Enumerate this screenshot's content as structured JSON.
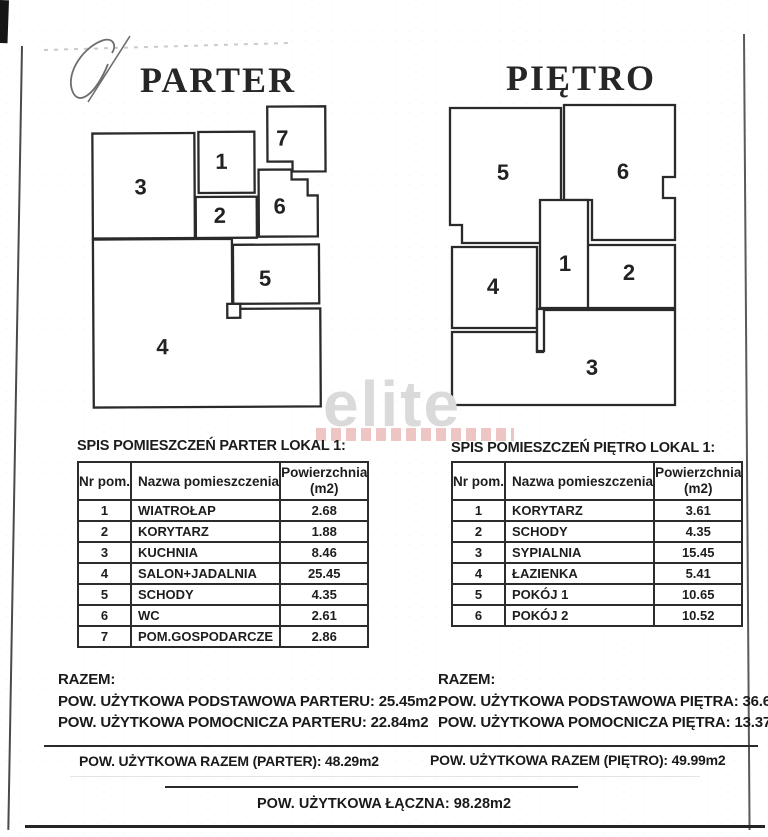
{
  "watermark": "elite",
  "grand_total": "POW. UŻYTKOWA ŁĄCZNA: 98.28m2",
  "parter": {
    "title": "PARTER",
    "plan_labels": [
      "1",
      "2",
      "3",
      "4",
      "5",
      "6",
      "7"
    ],
    "table_title": "SPIS POMIESZCZEŃ PARTER LOKAL 1:",
    "headers": {
      "col1": "Nr pom.",
      "col2": "Nazwa pomieszczenia",
      "col3a": "Powierzchnia",
      "col3b": "(m2)"
    },
    "rows": [
      {
        "nr": "1",
        "name": "WIATROŁAP",
        "area": "2.68"
      },
      {
        "nr": "2",
        "name": "KORYTARZ",
        "area": "1.88"
      },
      {
        "nr": "3",
        "name": "KUCHNIA",
        "area": "8.46"
      },
      {
        "nr": "4",
        "name": "SALON+JADALNIA",
        "area": "25.45"
      },
      {
        "nr": "5",
        "name": "SCHODY",
        "area": "4.35"
      },
      {
        "nr": "6",
        "name": "WC",
        "area": "2.61"
      },
      {
        "nr": "7",
        "name": "POM.GOSPODARCZE",
        "area": "2.86"
      }
    ],
    "razem_label": "RAZEM:",
    "summary_line1": "POW. UŻYTKOWA PODSTAWOWA PARTERU: 25.45m2",
    "summary_line2": "POW. UŻYTKOWA POMOCNICZA PARTERU: 22.84m2",
    "total_line": "POW. UŻYTKOWA RAZEM (PARTER): 48.29m2"
  },
  "pietro": {
    "title": "PIĘTRO",
    "plan_labels": [
      "1",
      "2",
      "3",
      "4",
      "5",
      "6"
    ],
    "table_title": "SPIS POMIESZCZEŃ PIĘTRO LOKAL 1:",
    "headers": {
      "col1": "Nr pom.",
      "col2": "Nazwa pomieszczenia",
      "col3a": "Powierzchnia",
      "col3b": "(m2)"
    },
    "rows": [
      {
        "nr": "1",
        "name": "KORYTARZ",
        "area": "3.61"
      },
      {
        "nr": "2",
        "name": "SCHODY",
        "area": "4.35"
      },
      {
        "nr": "3",
        "name": "SYPIALNIA",
        "area": "15.45"
      },
      {
        "nr": "4",
        "name": "ŁAZIENKA",
        "area": "5.41"
      },
      {
        "nr": "5",
        "name": "POKÓJ 1",
        "area": "10.65"
      },
      {
        "nr": "6",
        "name": "POKÓJ 2",
        "area": "10.52"
      }
    ],
    "razem_label": "RAZEM:",
    "summary_line1": "POW. UŻYTKOWA PODSTAWOWA PIĘTRA: 36.62m2",
    "summary_line2": "POW. UŻYTKOWA POMOCNICZA PIĘTRA: 13.37m2",
    "total_line": "POW. UŻYTKOWA RAZEM (PIĘTRO): 49.99m2"
  }
}
